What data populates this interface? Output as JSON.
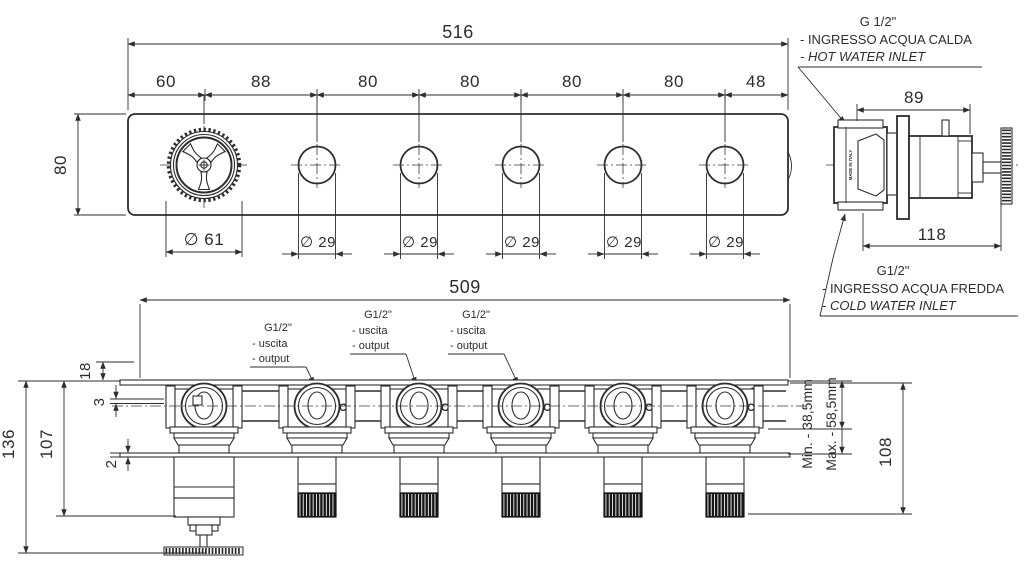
{
  "front_view": {
    "width_total": "516",
    "segments": [
      "60",
      "88",
      "80",
      "80",
      "80",
      "80",
      "48"
    ],
    "height": "80",
    "knob_diameter": "∅ 61",
    "hole_diameter": "∅ 29"
  },
  "side_view": {
    "dim_top": "89",
    "dim_bottom": "118",
    "made_in": "MADE IN ITALY",
    "hot": {
      "size": "G 1/2\"",
      "it": "- INGRESSO ACQUA CALDA",
      "en": "- HOT WATER INLET"
    },
    "cold": {
      "size": "G1/2\"",
      "it": "- INGRESSO ACQUA FREDDA",
      "en": "- COLD WATER INLET"
    }
  },
  "bottom_view": {
    "width_total": "509",
    "out": {
      "size": "G1/2\"",
      "it": "- uscita",
      "en": "- output"
    },
    "dim_wall": "18",
    "dim_gap": "3",
    "dim_plate": "2",
    "dim_body": "107",
    "dim_total": "136",
    "dim_right": "108",
    "min_label": "Min. - 38,5mm",
    "max_label": "Max. - 58,5mm",
    "c_mark": "C"
  },
  "colors": {
    "hot": "#e8262e",
    "cold": "#2424c8",
    "line": "#2d2d2d"
  }
}
